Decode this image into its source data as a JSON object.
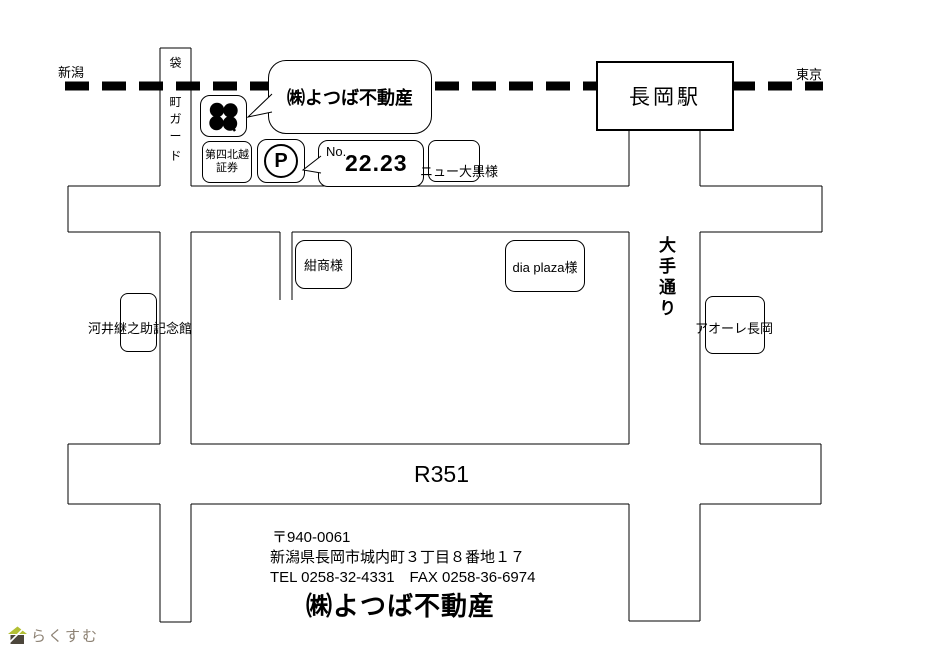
{
  "railway": {
    "left_label": "新潟",
    "right_label": "東京"
  },
  "station": {
    "label": "長岡駅"
  },
  "roads": {
    "fukuromachi_chars": [
      "袋",
      "町",
      "ガ",
      "ー",
      "ド"
    ],
    "otedori_label": "大手通り",
    "route_label": "R351"
  },
  "landmarks": {
    "company_bubble": "㈱よつば不動産",
    "securities_line1": "第四北越",
    "securities_line2": "証券",
    "parking_letter": "P",
    "parking_no_label": "No.",
    "parking_no_value": "22.23",
    "new_daikoku": "ニュー大黒様",
    "konsho": "紺商様",
    "dia_plaza": "dia plaza様",
    "kawai_memorial": "河井継之助記念館",
    "aore_nagaoka": "アオーレ長岡"
  },
  "footer": {
    "postal_code": "〒940-0061",
    "address": "新潟県長岡市城内町３丁目８番地１７",
    "tel_fax": "TEL 0258-32-4331　FAX 0258-36-6974",
    "company_name": "㈱よつば不動産"
  },
  "watermark": {
    "text": "らくすむ",
    "text_color": "#8d8274",
    "roof_color": "#b2bf33",
    "body_color": "#4c463b"
  },
  "colors": {
    "line": "#000000",
    "background": "#ffffff"
  }
}
